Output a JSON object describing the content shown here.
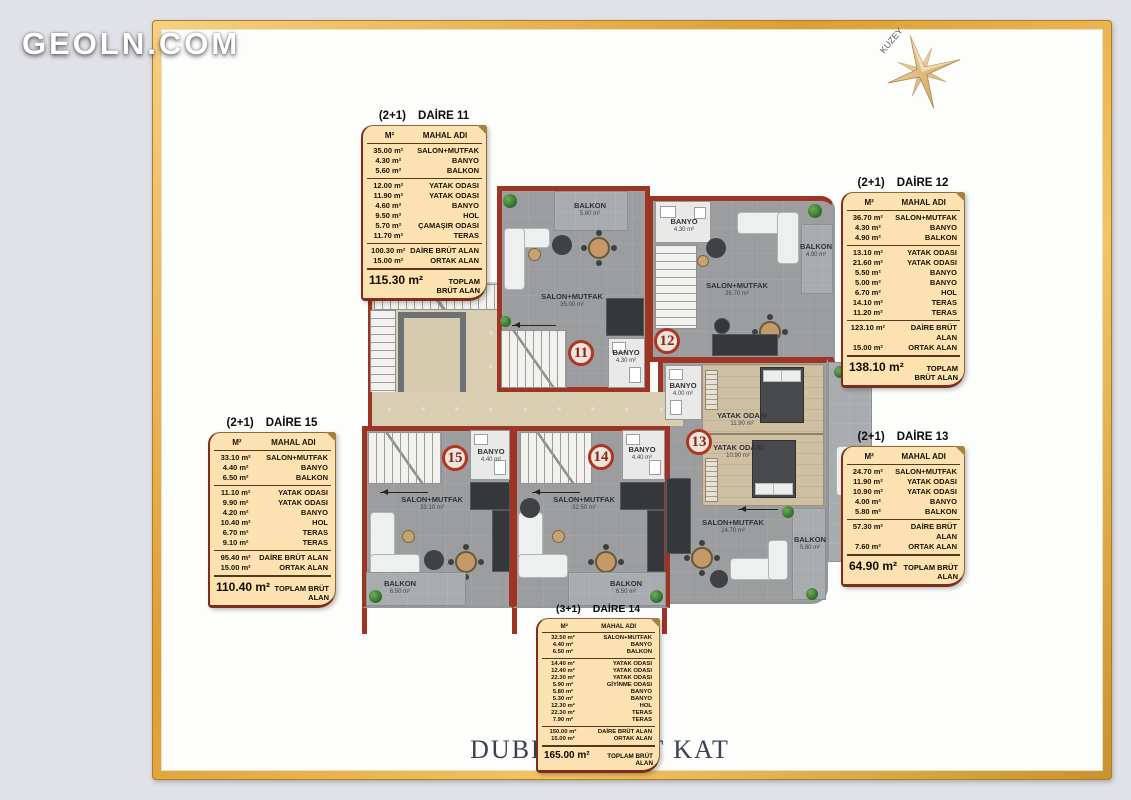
{
  "page": {
    "logo": "GEOLN.COM",
    "title": "DUBLEKS ALT KAT",
    "compass_label": "KUZEY"
  },
  "colors": {
    "frame_gold": "#e0a63c",
    "wall_red": "#9e3524",
    "table_bg": "#fbe2b0",
    "floor_gray": "#9b9d9f",
    "core_beige": "#d9cdb2",
    "bedroom_wood": "#cfc0a3",
    "unit_circle_red": "#b23422"
  },
  "tables": [
    {
      "type": "(2+1)",
      "name": "DAİRE 11",
      "col_area": "M²",
      "col_room": "MAHAL ADI",
      "groups": [
        [
          {
            "a": "35.00 m²",
            "r": "SALON+MUTFAK"
          },
          {
            "a": "4.30 m²",
            "r": "BANYO"
          },
          {
            "a": "5.60 m²",
            "r": "BALKON"
          }
        ],
        [
          {
            "a": "12.00 m²",
            "r": "YATAK ODASI"
          },
          {
            "a": "11.90 m²",
            "r": "YATAK ODASI"
          },
          {
            "a": "4.60 m²",
            "r": "BANYO"
          },
          {
            "a": "9.50 m²",
            "r": "HOL"
          },
          {
            "a": "5.70 m²",
            "r": "ÇAMAŞIR ODASI"
          },
          {
            "a": "11.70 m²",
            "r": "TERAS"
          }
        ],
        [
          {
            "a": "100.30 m²",
            "r": "DAİRE BRÜT ALAN"
          },
          {
            "a": "15.00 m²",
            "r": "ORTAK ALAN"
          }
        ]
      ],
      "total_area": "115.30 m²",
      "total_label": "TOPLAM BRÜT ALAN"
    },
    {
      "type": "(2+1)",
      "name": "DAİRE 12",
      "col_area": "M²",
      "col_room": "MAHAL ADI",
      "groups": [
        [
          {
            "a": "36.70 m²",
            "r": "SALON+MUTFAK"
          },
          {
            "a": "4.30 m²",
            "r": "BANYO"
          },
          {
            "a": "4.90 m²",
            "r": "BALKON"
          }
        ],
        [
          {
            "a": "13.10 m²",
            "r": "YATAK ODASI"
          },
          {
            "a": "21.60 m²",
            "r": "YATAK ODASI"
          },
          {
            "a": "5.50 m²",
            "r": "BANYO"
          },
          {
            "a": "5.00 m²",
            "r": "BANYO"
          },
          {
            "a": "6.70 m²",
            "r": "HOL"
          },
          {
            "a": "14.10 m²",
            "r": "TERAS"
          },
          {
            "a": "11.20 m²",
            "r": "TERAS"
          }
        ],
        [
          {
            "a": "123.10 m²",
            "r": "DAİRE BRÜT ALAN"
          },
          {
            "a": "15.00 m²",
            "r": "ORTAK ALAN"
          }
        ]
      ],
      "total_area": "138.10 m²",
      "total_label": "TOPLAM BRÜT ALAN"
    },
    {
      "type": "(2+1)",
      "name": "DAİRE 13",
      "col_area": "M²",
      "col_room": "MAHAL ADI",
      "groups": [
        [
          {
            "a": "24.70 m²",
            "r": "SALON+MUTFAK"
          },
          {
            "a": "11.90 m²",
            "r": "YATAK ODASI"
          },
          {
            "a": "10.90 m²",
            "r": "YATAK ODASI"
          },
          {
            "a": "4.00 m²",
            "r": "BANYO"
          },
          {
            "a": "5.80 m²",
            "r": "BALKON"
          }
        ],
        [
          {
            "a": "57.30 m²",
            "r": "DAİRE BRÜT ALAN"
          },
          {
            "a": "7.60 m²",
            "r": "ORTAK ALAN"
          }
        ]
      ],
      "total_area": "64.90 m²",
      "total_label": "TOPLAM BRÜT ALAN"
    },
    {
      "type": "(3+1)",
      "name": "DAİRE 14",
      "col_area": "M²",
      "col_room": "MAHAL ADI",
      "groups": [
        [
          {
            "a": "32.50 m²",
            "r": "SALON+MUTFAK"
          },
          {
            "a": "4.40 m²",
            "r": "BANYO"
          },
          {
            "a": "6.50 m²",
            "r": "BALKON"
          }
        ],
        [
          {
            "a": "14.40 m²",
            "r": "YATAK ODASI"
          },
          {
            "a": "12.40 m²",
            "r": "YATAK ODASI"
          },
          {
            "a": "22.30 m²",
            "r": "YATAK ODASI"
          },
          {
            "a": "5.90 m²",
            "r": "GİYİNME ODASI"
          },
          {
            "a": "5.80 m²",
            "r": "BANYO"
          },
          {
            "a": "5.30 m²",
            "r": "BANYO"
          },
          {
            "a": "12.30 m²",
            "r": "HOL"
          },
          {
            "a": "22.30 m²",
            "r": "TERAS"
          },
          {
            "a": "7.90 m²",
            "r": "TERAS"
          }
        ],
        [
          {
            "a": "150.00 m²",
            "r": "DAİRE BRÜT ALAN"
          },
          {
            "a": "15.00 m²",
            "r": "ORTAK ALAN"
          }
        ]
      ],
      "total_area": "165.00 m²",
      "total_label": "TOPLAM BRÜT ALAN"
    },
    {
      "type": "(2+1)",
      "name": "DAİRE 15",
      "col_area": "M²",
      "col_room": "MAHAL ADI",
      "groups": [
        [
          {
            "a": "33.10 m²",
            "r": "SALON+MUTFAK"
          },
          {
            "a": "4.40 m²",
            "r": "BANYO"
          },
          {
            "a": "6.50 m²",
            "r": "BALKON"
          }
        ],
        [
          {
            "a": "11.10 m²",
            "r": "YATAK ODASI"
          },
          {
            "a": "9.90 m²",
            "r": "YATAK ODASI"
          },
          {
            "a": "4.20 m²",
            "r": "BANYO"
          },
          {
            "a": "10.40 m²",
            "r": "HOL"
          },
          {
            "a": "6.70 m²",
            "r": "TERAS"
          },
          {
            "a": "9.10 m²",
            "r": "TERAS"
          }
        ],
        [
          {
            "a": "95.40 m²",
            "r": "DAİRE BRÜT ALAN"
          },
          {
            "a": "15.00 m²",
            "r": "ORTAK ALAN"
          }
        ]
      ],
      "total_area": "110.40 m²",
      "total_label": "TOPLAM BRÜT ALAN"
    }
  ],
  "plan": {
    "units": [
      {
        "no": "11"
      },
      {
        "no": "12"
      },
      {
        "no": "13"
      },
      {
        "no": "14"
      },
      {
        "no": "15"
      }
    ],
    "labels": {
      "balkon11": {
        "t": "BALKON",
        "s": "5.60 m²"
      },
      "salon11": {
        "t": "SALON+MUTFAK",
        "s": "35.00 m²"
      },
      "banyo11": {
        "t": "BANYO",
        "s": "4.30 m²"
      },
      "banyo12": {
        "t": "BANYO",
        "s": "4.30 m²"
      },
      "salon12": {
        "t": "SALON+MUTFAK",
        "s": "36.70 m²"
      },
      "balkon12": {
        "t": "BALKON",
        "s": "4.90 m²"
      },
      "banyo13": {
        "t": "BANYO",
        "s": "4.00 m²"
      },
      "yatak13a": {
        "t": "YATAK ODASI",
        "s": "11.90 m²"
      },
      "yatak13b": {
        "t": "YATAK ODASI",
        "s": "10.90 m²"
      },
      "salon13": {
        "t": "SALON+MUTFAK",
        "s": "24.70 m²"
      },
      "balkon13": {
        "t": "BALKON",
        "s": "5.80 m²"
      },
      "salon14": {
        "t": "SALON+MUTFAK",
        "s": "32.50 m²"
      },
      "banyo14": {
        "t": "BANYO",
        "s": "4.40 m²"
      },
      "balkon14": {
        "t": "BALKON",
        "s": "6.50 m²"
      },
      "salon15": {
        "t": "SALON+MUTFAK",
        "s": "33.10 m²"
      },
      "banyo15": {
        "t": "BANYO",
        "s": "4.40 m²"
      },
      "balkon15": {
        "t": "BALKON",
        "s": "6.50 m²"
      }
    }
  }
}
